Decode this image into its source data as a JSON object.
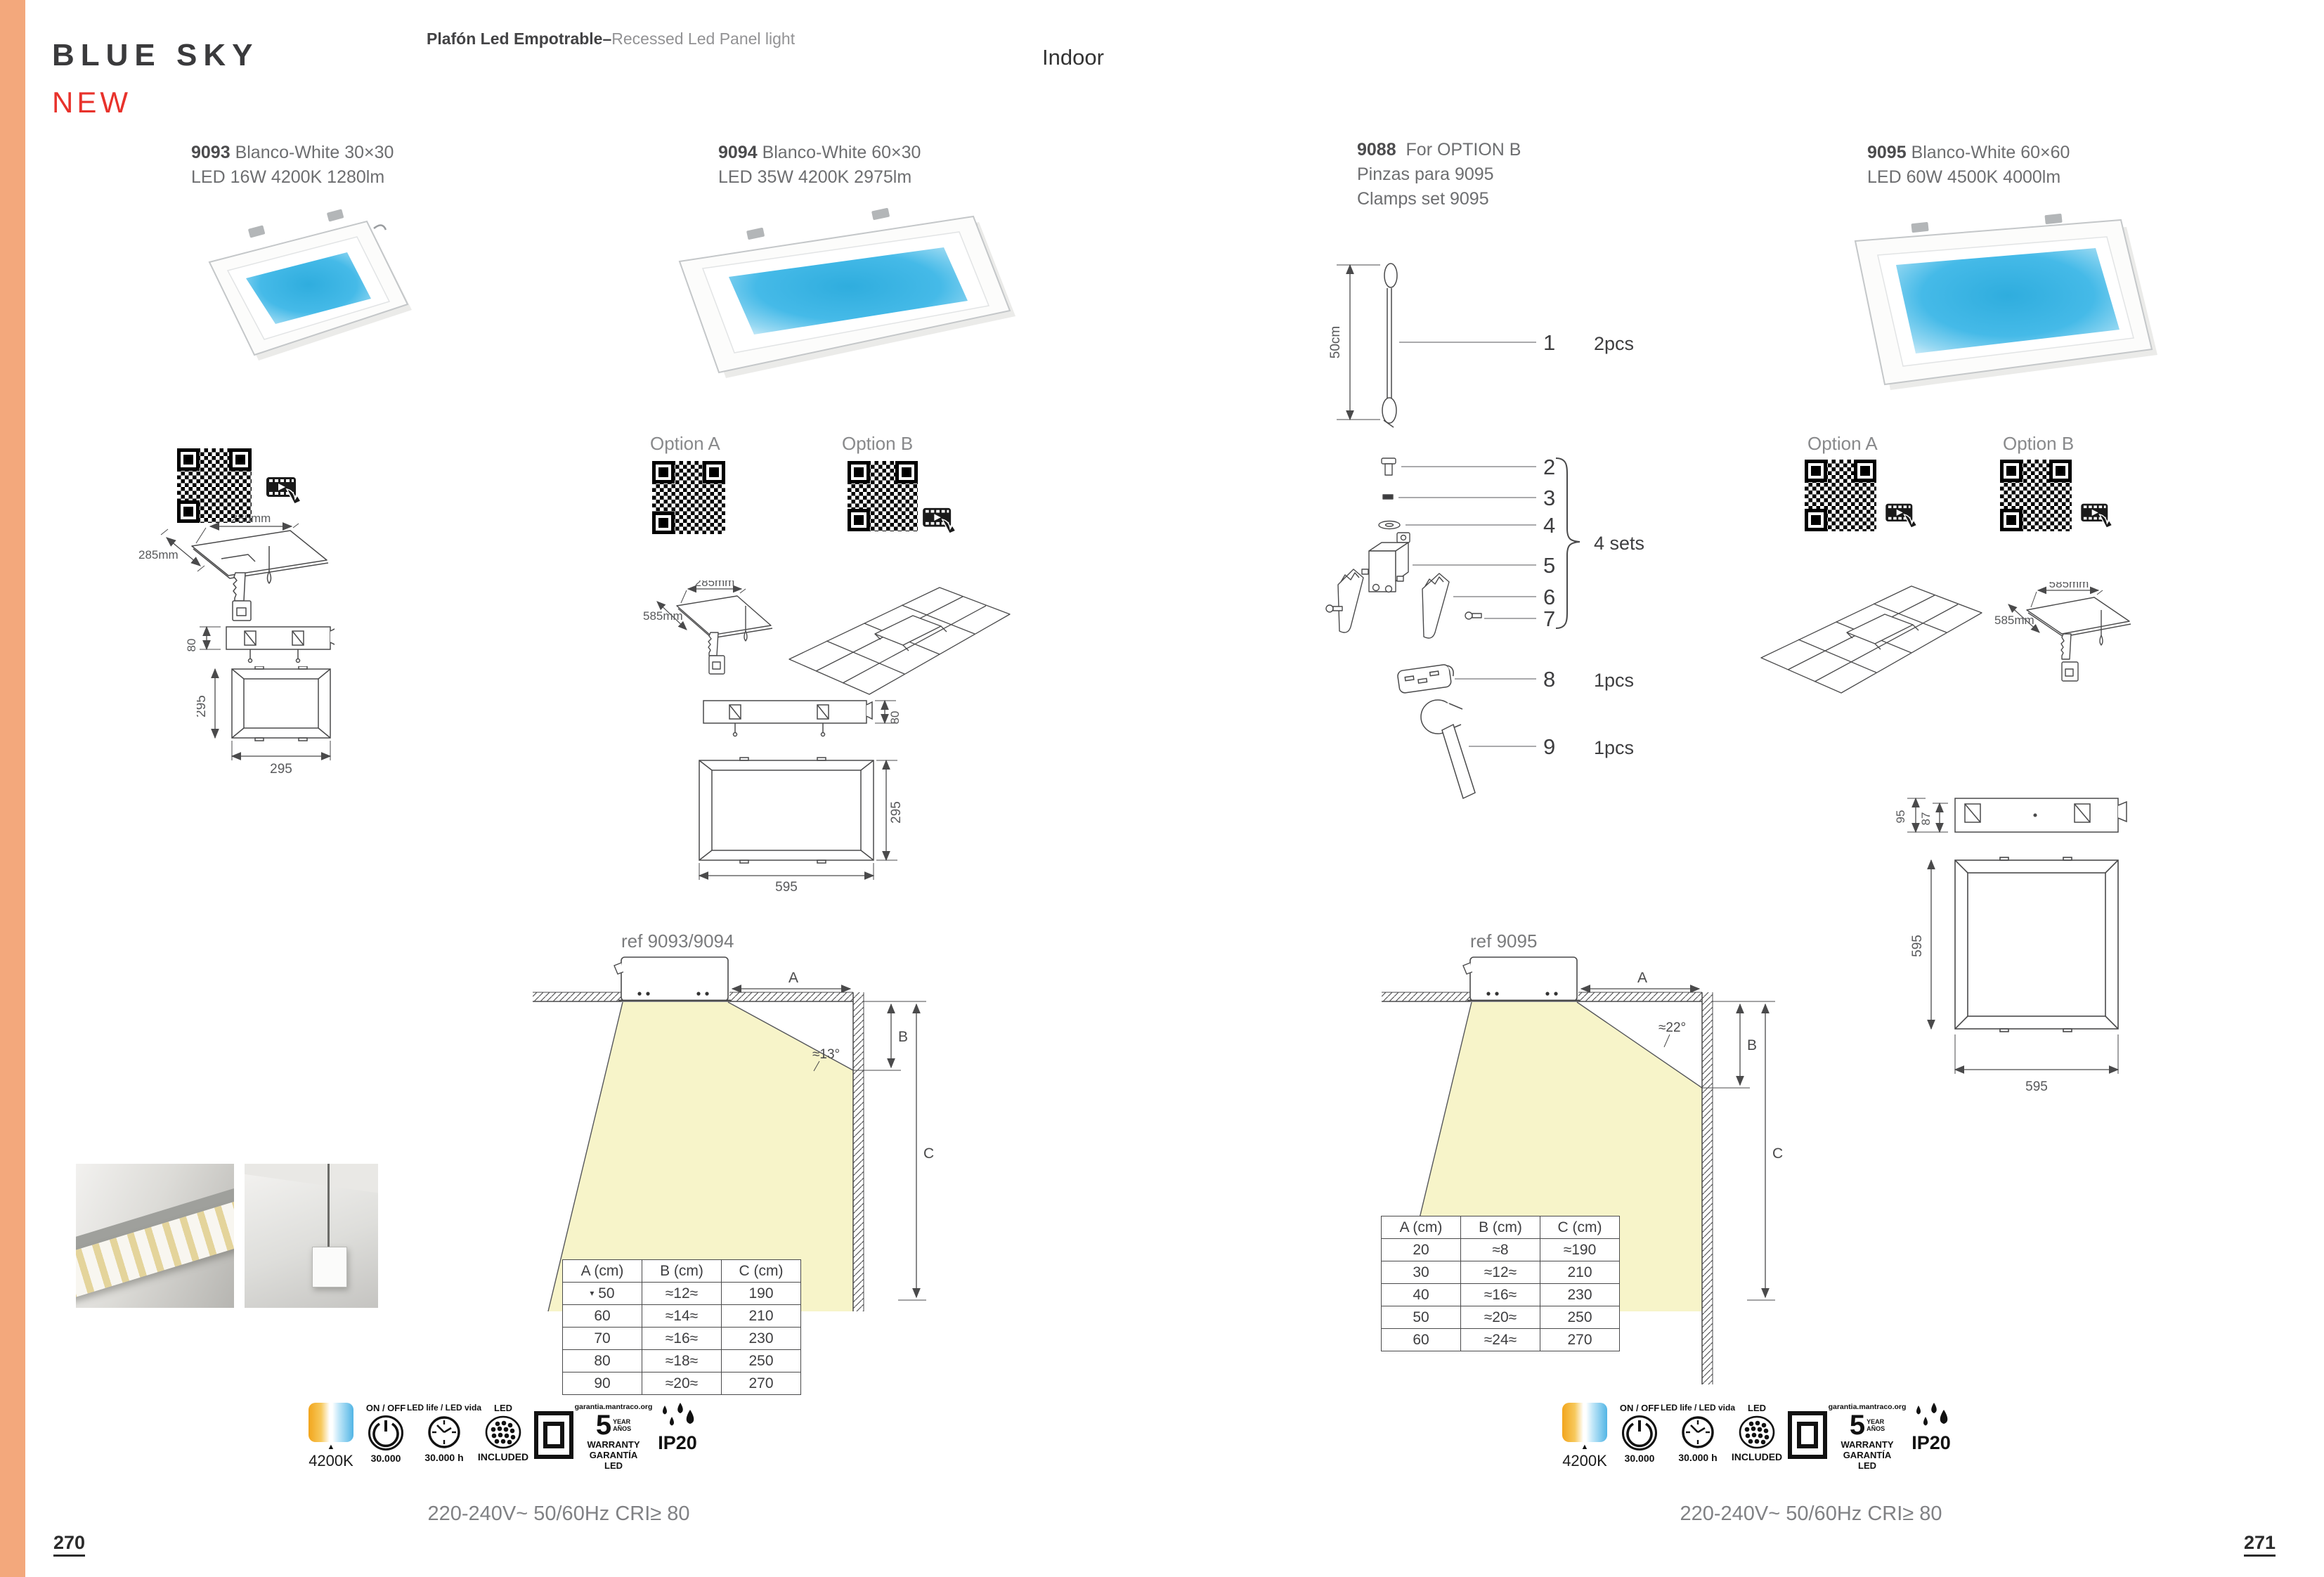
{
  "page": {
    "title": "BLUE SKY",
    "badge": "NEW",
    "subtitle_primary": "Plafón Led Empotrable–",
    "subtitle_secondary": "Recessed Led Panel light",
    "category": "Indoor",
    "page_number_left": "270",
    "page_number_right": "271"
  },
  "products": {
    "p9093": {
      "code": "9093",
      "name": "Blanco-White  30×30",
      "spec": "LED 16W 4200K 1280lm"
    },
    "p9094": {
      "code": "9094",
      "name": "Blanco-White 60×30",
      "spec": "LED 35W 4200K 2975lm"
    },
    "p9088": {
      "code": "9088",
      "name": "For OPTION B",
      "line2": "Pinzas para 9095",
      "line3": "Clamps set 9095"
    },
    "p9095": {
      "code": "9095",
      "name": "Blanco-White  60×60",
      "spec": "LED 60W 4500K 4000lm"
    }
  },
  "options": {
    "a": "Option A",
    "b": "Option B"
  },
  "dims": {
    "w285": "285mm",
    "w585": "585mm",
    "h80": "80",
    "s295": "295",
    "s595": "595",
    "h95": "95",
    "h87": "87"
  },
  "clamps": {
    "cable_length": "50cm",
    "sets_label": "4 sets",
    "items": [
      {
        "num": "1",
        "qty": "2pcs"
      },
      {
        "num": "2",
        "qty": ""
      },
      {
        "num": "3",
        "qty": ""
      },
      {
        "num": "4",
        "qty": ""
      },
      {
        "num": "5",
        "qty": ""
      },
      {
        "num": "6",
        "qty": ""
      },
      {
        "num": "7",
        "qty": ""
      },
      {
        "num": "8",
        "qty": "1pcs"
      },
      {
        "num": "9",
        "qty": "1pcs"
      }
    ]
  },
  "beam_left": {
    "ref": "ref 9093/9094",
    "angle": "≈13°",
    "label_a": "A",
    "label_b": "B",
    "label_c": "C"
  },
  "beam_right": {
    "ref": "ref 9095",
    "angle": "≈22°",
    "label_a": "A",
    "label_b": "B",
    "label_c": "C"
  },
  "table_left": {
    "headers": [
      "A (cm)",
      "B (cm)",
      "C (cm)"
    ],
    "marker": "▾",
    "rows": [
      [
        "50",
        "≈12≈",
        "190"
      ],
      [
        "60",
        "≈14≈",
        "210"
      ],
      [
        "70",
        "≈16≈",
        "230"
      ],
      [
        "80",
        "≈18≈",
        "250"
      ],
      [
        "90",
        "≈20≈",
        "270"
      ]
    ]
  },
  "table_right": {
    "headers": [
      "A (cm)",
      "B (cm)",
      "C (cm)"
    ],
    "rows": [
      [
        "20",
        "≈8",
        "≈190"
      ],
      [
        "30",
        "≈12≈",
        "210"
      ],
      [
        "40",
        "≈16≈",
        "230"
      ],
      [
        "50",
        "≈20≈",
        "250"
      ],
      [
        "60",
        "≈24≈",
        "270"
      ]
    ]
  },
  "icons": {
    "cct_value": "4200K",
    "onoff_top": "ON / OFF",
    "onoff_bottom": "30.000",
    "ledlife_top": "LED life / LED vida",
    "ledlife_bottom": "30.000 h",
    "led_top": "LED",
    "led_bottom": "INCLUDED",
    "warranty_arc": "garantia.mantraco.org",
    "warranty_number": "5",
    "warranty_year": "YEAR",
    "warranty_anos": "AÑOS",
    "warranty_l1": "WARRANTY",
    "warranty_l2": "GARANTÍA",
    "warranty_l3": "LED",
    "ip_rating": "IP20"
  },
  "footer": {
    "electrical": "220-240V~ 50/60Hz CRI≥ 80"
  }
}
